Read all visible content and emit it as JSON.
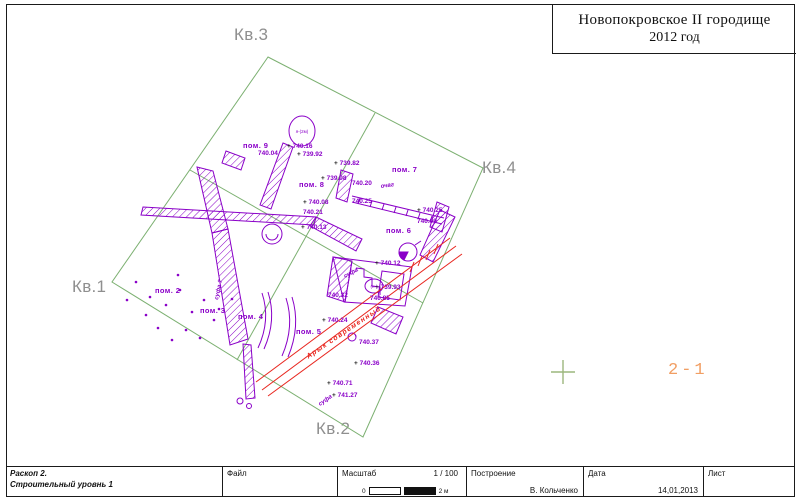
{
  "title": {
    "line1": "Новопокровское  II городище",
    "line2": "2012 год"
  },
  "quadrants": [
    {
      "label": "Кв.3"
    },
    {
      "label": "Кв.4"
    },
    {
      "label": "Кв.1"
    },
    {
      "label": "Кв.2"
    }
  ],
  "site_label": {
    "text": "2-1"
  },
  "plan": {
    "colors": {
      "purple": "#8a00c8",
      "green": "#7cb071",
      "red": "#e8261f",
      "gray": "#8f8f8f",
      "orange": "#f19e63"
    },
    "rooms": [
      {
        "label": "пом. 9",
        "x": 243,
        "y": 148
      },
      {
        "label": "пом. 8",
        "x": 299,
        "y": 187
      },
      {
        "label": "пом. 7",
        "x": 392,
        "y": 172
      },
      {
        "label": "пом. 6",
        "x": 386,
        "y": 233
      },
      {
        "label": "пом. 5",
        "x": 296,
        "y": 334
      },
      {
        "label": "пом. 4",
        "x": 238,
        "y": 319
      },
      {
        "label": "пом. 3",
        "x": 200,
        "y": 313
      },
      {
        "label": "пом. 2",
        "x": 155,
        "y": 293
      }
    ],
    "elevations": [
      {
        "x": 258,
        "y": 155,
        "v": "740.04",
        "plus": false
      },
      {
        "x": 287,
        "y": 148,
        "v": "740.16",
        "plus": true
      },
      {
        "x": 297,
        "y": 156,
        "v": "739.92",
        "plus": true
      },
      {
        "x": 334,
        "y": 165,
        "v": "739.82",
        "plus": true
      },
      {
        "x": 321,
        "y": 180,
        "v": "739.98",
        "plus": true
      },
      {
        "x": 352,
        "y": 185,
        "v": "740.20",
        "plus": false
      },
      {
        "x": 352,
        "y": 203,
        "v": "740.25",
        "plus": false
      },
      {
        "x": 417,
        "y": 212,
        "v": "740.25",
        "plus": true
      },
      {
        "x": 417,
        "y": 223,
        "v": "740.09",
        "plus": false
      },
      {
        "x": 303,
        "y": 204,
        "v": "740.08",
        "plus": true
      },
      {
        "x": 303,
        "y": 214,
        "v": "740.21",
        "plus": false
      },
      {
        "x": 301,
        "y": 229,
        "v": "740.13",
        "plus": true
      },
      {
        "x": 375,
        "y": 265,
        "v": "740.12",
        "plus": true
      },
      {
        "x": 375,
        "y": 289,
        "v": "739.93",
        "plus": true
      },
      {
        "x": 370,
        "y": 300,
        "v": "740.85",
        "plus": false
      },
      {
        "x": 328,
        "y": 297,
        "v": "740.32",
        "plus": false
      },
      {
        "x": 322,
        "y": 322,
        "v": "740.24",
        "plus": true
      },
      {
        "x": 359,
        "y": 344,
        "v": "740.37",
        "plus": false
      },
      {
        "x": 354,
        "y": 365,
        "v": "740.36",
        "plus": true
      },
      {
        "x": 327,
        "y": 385,
        "v": "740.71",
        "plus": true
      },
      {
        "x": 332,
        "y": 397,
        "v": "741.27",
        "plus": true
      }
    ],
    "notes": [
      {
        "t": "суфа",
        "x": 345,
        "y": 278,
        "r": -28
      },
      {
        "t": "суфа",
        "x": 320,
        "y": 406,
        "r": -35
      },
      {
        "t": "суфа ?",
        "x": 218,
        "y": 300,
        "r": -78
      },
      {
        "t": "очаг",
        "x": 381,
        "y": 188,
        "r": -8
      }
    ],
    "feature_labels": [
      {
        "t": "я-(2м)",
        "x": 302,
        "y": 133
      },
      {
        "t": "(н-)",
        "x": 374,
        "y": 288
      }
    ],
    "arik_label": {
      "text": "Арык современный",
      "x": 345,
      "y": 334,
      "r": -34
    }
  },
  "titleblock": {
    "project_line1": "Раскоп 2.",
    "project_line2": "Строительный уровнь 1",
    "file_label": "Файл",
    "scale_label": "Масштаб",
    "scale_value": "1 / 100",
    "scale_zero": "0",
    "scale_end": "2 м",
    "built_label": "Построение",
    "built_value": "В. Кольченко",
    "date_label": "Дата",
    "date_value": "14,01,2013",
    "sheet_label": "Лист"
  }
}
